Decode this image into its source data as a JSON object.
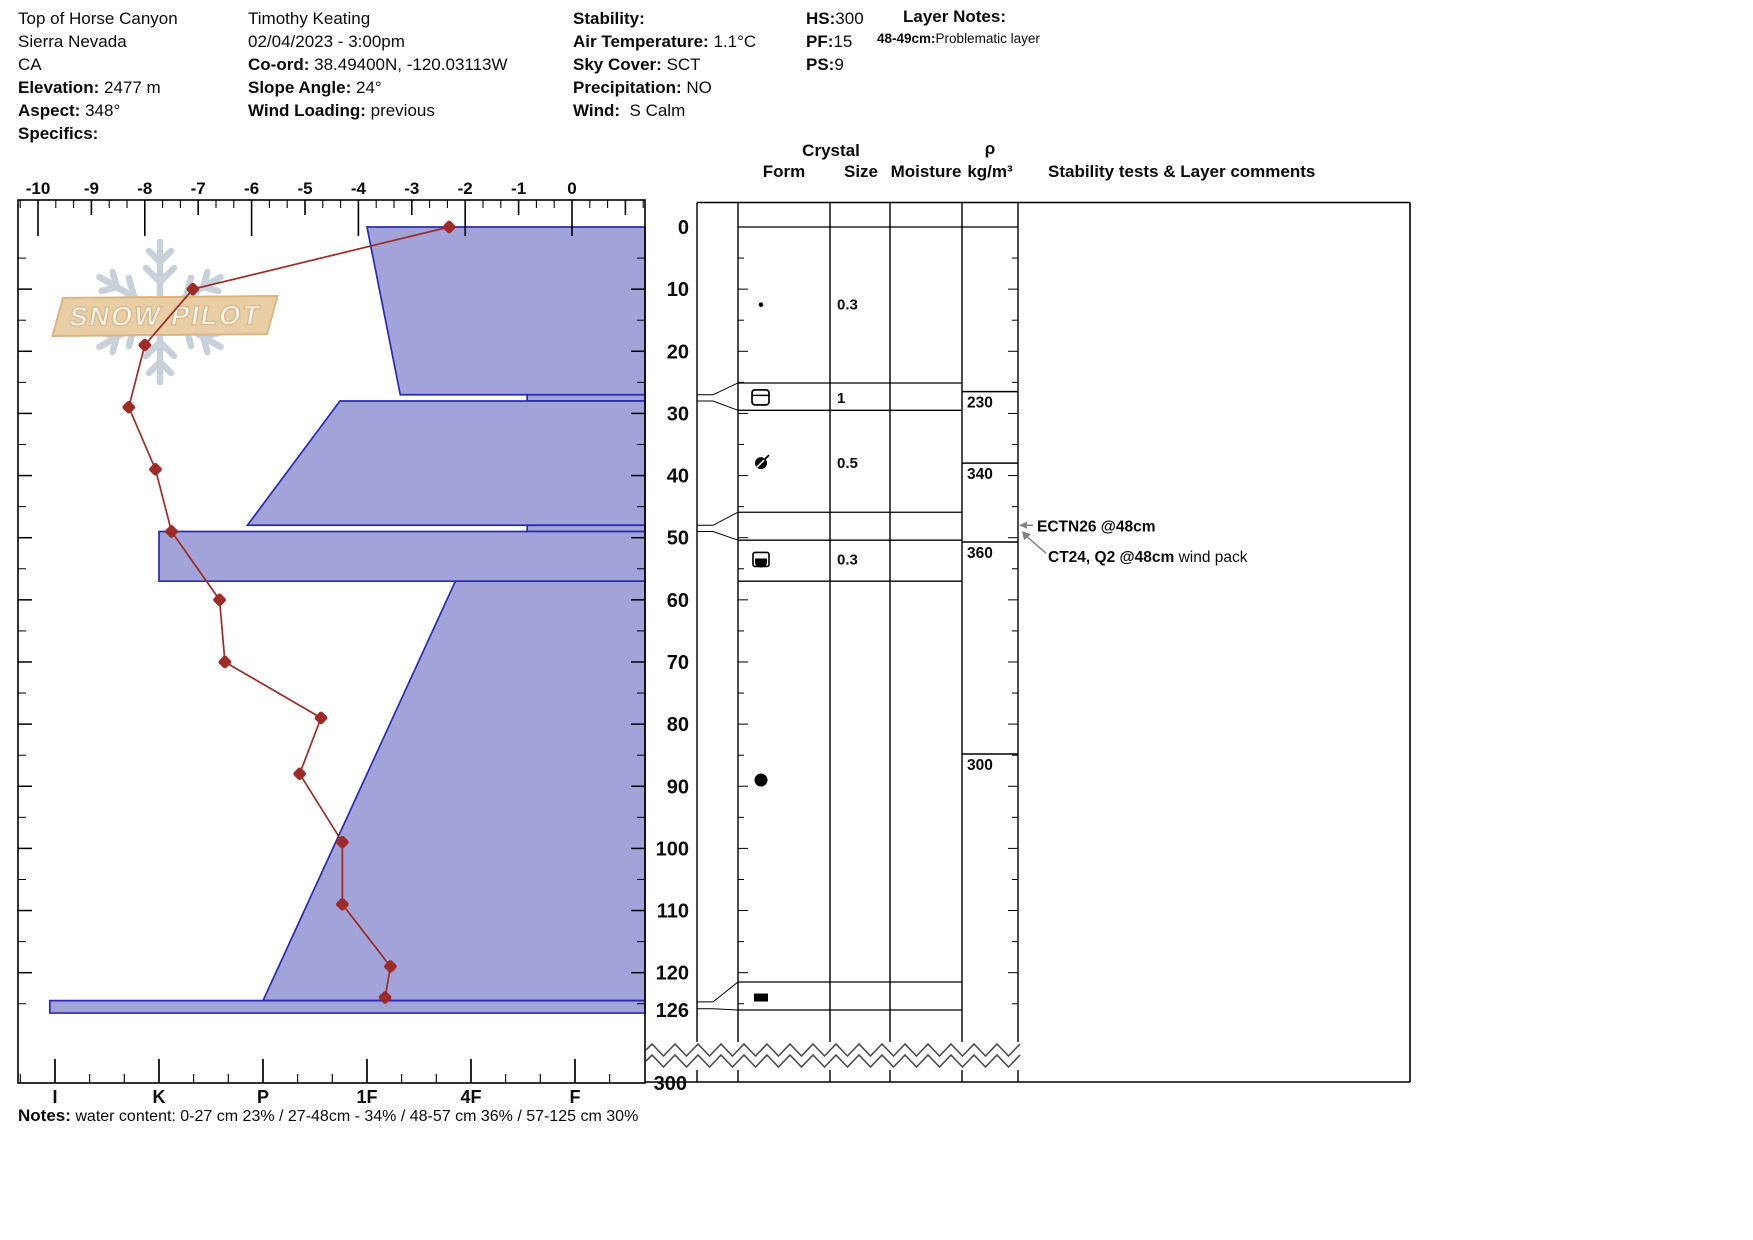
{
  "header": {
    "col1": {
      "line1": "Top of Horse Canyon",
      "line2": "Sierra Nevada",
      "line3": "CA",
      "elevation_label": "Elevation:",
      "elevation_value": "2477 m",
      "aspect_label": "Aspect:",
      "aspect_value": "348°",
      "specifics_label": "Specifics:"
    },
    "col2": {
      "observer": "Timothy Keating",
      "datetime": "02/04/2023 - 3:00pm",
      "coord_label": "Co-ord:",
      "coord_value": "38.49400N, -120.03113W",
      "slope_label": "Slope Angle:",
      "slope_value": "24°",
      "wind_loading_label": "Wind Loading:",
      "wind_loading_value": "previous"
    },
    "col3": {
      "stability_label": "Stability:",
      "air_temp_label": "Air Temperature:",
      "air_temp_value": "1.1°C",
      "sky_label": "Sky Cover:",
      "sky_value": "SCT",
      "precip_label": "Precipitation:",
      "precip_value": "NO",
      "wind_label": "Wind:",
      "wind_value": "S Calm"
    },
    "col4": {
      "hs_label": "HS:",
      "hs_value": "300",
      "pf_label": "PF:",
      "pf_value": "15",
      "ps_label": "PS:",
      "ps_value": "9"
    },
    "layer_notes": {
      "title": "Layer Notes:",
      "entry_range": "48-49cm:",
      "entry_text": "Problematic layer"
    }
  },
  "logo": {
    "text": "SNOW PILOT"
  },
  "notes": {
    "label": "Notes:",
    "text": "water content: 0-27 cm 23% / 27-48cm - 34% / 48-57 cm 36% / 57-125 cm 30%"
  },
  "chart_data": {
    "type": "snow-profile",
    "title": "Snow pit profile: temperature, hand hardness, crystals, density",
    "temp_axis": {
      "unit": "°C",
      "min": -10,
      "max": 0,
      "tick_labels": [
        "-10",
        "-9",
        "-8",
        "-7",
        "-6",
        "-5",
        "-4",
        "-3",
        "-2",
        "-1",
        "0"
      ]
    },
    "hardness_axis": {
      "labels": [
        "I",
        "K",
        "P",
        "1F",
        "4F",
        "F"
      ]
    },
    "depth_axis": {
      "unit": "cm",
      "labels": [
        "0",
        "10",
        "20",
        "30",
        "40",
        "50",
        "60",
        "70",
        "80",
        "90",
        "100",
        "110",
        "120",
        "126"
      ],
      "break_label": "300"
    },
    "temperature_profile": [
      {
        "depth": 0,
        "temp": -2.3
      },
      {
        "depth": 10,
        "temp": -7.1
      },
      {
        "depth": 19,
        "temp": -8.0
      },
      {
        "depth": 29,
        "temp": -8.3
      },
      {
        "depth": 39,
        "temp": -7.8
      },
      {
        "depth": 49,
        "temp": -7.5
      },
      {
        "depth": 60,
        "temp": -6.6
      },
      {
        "depth": 70,
        "temp": -6.5
      },
      {
        "depth": 79,
        "temp": -4.7
      },
      {
        "depth": 88,
        "temp": -5.1
      },
      {
        "depth": 99,
        "temp": -4.3
      },
      {
        "depth": 109,
        "temp": -4.3
      },
      {
        "depth": 119,
        "temp": -3.4
      },
      {
        "depth": 124,
        "temp": -3.5
      }
    ],
    "layers": [
      {
        "top_cm": 0,
        "bottom_cm": 27,
        "hardness": "1F",
        "h_top": 4.0,
        "h_bottom": 4.32,
        "thin": false
      },
      {
        "top_cm": 27,
        "bottom_cm": 28,
        "hardness": "4F-F",
        "h_top": 5.54,
        "h_bottom": 5.54,
        "thin": true
      },
      {
        "top_cm": 28,
        "bottom_cm": 48,
        "hardness": "1F-P",
        "h_top": 3.74,
        "h_bottom": 2.85,
        "thin": false
      },
      {
        "top_cm": 48,
        "bottom_cm": 49,
        "hardness": "4F-F",
        "h_top": 5.54,
        "h_bottom": 5.54,
        "thin": true
      },
      {
        "top_cm": 49,
        "bottom_cm": 57,
        "hardness": "K",
        "h_top": 2.0,
        "h_bottom": 2.0,
        "thin": false
      },
      {
        "top_cm": 57,
        "bottom_cm": 124.5,
        "hardness": "4F-P",
        "h_top": 4.85,
        "h_bottom": 3.0,
        "thin": false
      },
      {
        "top_cm": 124.5,
        "bottom_cm": 126.5,
        "hardness": "I",
        "h_top": 0.95,
        "h_bottom": 0.95,
        "thin": true
      }
    ],
    "grain_rows": [
      {
        "depth_cm": 12.5,
        "form": "pp-dot",
        "size": "0.3"
      },
      {
        "depth_cm": 27.5,
        "form": "crust",
        "size": "1"
      },
      {
        "depth_cm": 38,
        "form": "rg-slash",
        "size": "0.5"
      },
      {
        "depth_cm": 53.5,
        "form": "mf-cup",
        "size": "0.3"
      },
      {
        "depth_cm": 89,
        "form": "rg-round",
        "size": ""
      },
      {
        "depth_cm": 124,
        "form": "ice-lens",
        "size": ""
      }
    ],
    "density": [
      {
        "from_cm": 26.5,
        "to_cm": 38,
        "value": "230"
      },
      {
        "from_cm": 38,
        "to_cm": 50.7,
        "value": "340"
      },
      {
        "from_cm": 50.7,
        "to_cm": 84.8,
        "value": "360"
      },
      {
        "from_cm": 84.8,
        "to_cm": 126,
        "value": "300"
      }
    ],
    "tests": [
      {
        "label": "ECTN26 @48cm",
        "comment": "",
        "depth_cm": 48
      },
      {
        "label": "CT24, Q2 @48cm",
        "comment": "wind pack",
        "depth_cm": 48.8
      }
    ],
    "table_headers": {
      "crystal": "Crystal",
      "form": "Form",
      "size": "Size",
      "moisture": "Moisture",
      "rho": "ρ",
      "rho_unit": "kg/m³",
      "stability": "Stability tests & Layer comments"
    },
    "row_lines_cm": [
      25.1,
      29.5,
      45.9,
      50.4,
      57,
      121.5,
      126
    ],
    "flags": [
      {
        "from_cm": 27,
        "to_cm": 28,
        "row_from_cm": 25.1,
        "row_to_cm": 29.5
      },
      {
        "from_cm": 48,
        "to_cm": 49,
        "row_from_cm": 45.9,
        "row_to_cm": 50.4
      },
      {
        "from_cm": 124.7,
        "to_cm": 125.8,
        "row_from_cm": 121.5,
        "row_to_cm": 126
      }
    ],
    "colors": {
      "bar_fill": "#a2a3d8",
      "bar_stroke": "#2b2bb0",
      "temp_line": "#9e2b28",
      "arrow_gray": "#818181",
      "snowflake": "#c8d1da"
    }
  }
}
